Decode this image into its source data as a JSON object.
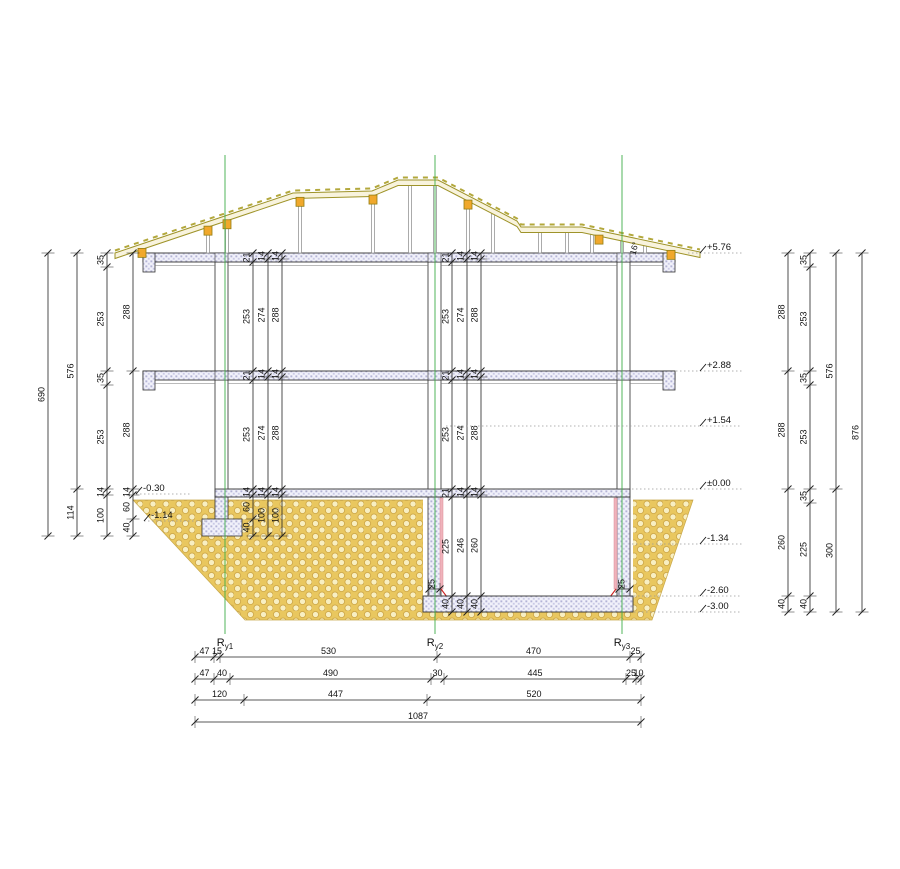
{
  "drawing": {
    "angle_label": "16°",
    "axes": [
      {
        "base": "R",
        "sub": "y1"
      },
      {
        "base": "R",
        "sub": "y2"
      },
      {
        "base": "R",
        "sub": "y3"
      }
    ],
    "elevations_right": [
      "+5.76",
      "+2.88",
      "+1.54",
      "±0.00",
      "-1.34",
      "-2.60",
      "-3.00"
    ],
    "elevations_left": [
      "-0.30",
      "-1.14"
    ],
    "dims": {
      "left_total": [
        "690"
      ],
      "left_sub": [
        "576",
        "114"
      ],
      "left_storey": [
        "35",
        "253",
        "35",
        "253",
        "14",
        "100"
      ],
      "left_inner": [
        "288",
        "288",
        "14",
        "60",
        "40"
      ],
      "int_l1": [
        "21",
        "253",
        "21",
        "253",
        "14",
        "60",
        "40"
      ],
      "int_l2": [
        "14",
        "274",
        "14",
        "274",
        "14",
        "100"
      ],
      "int_l3": [
        "14",
        "288",
        "14",
        "288",
        "14",
        "100"
      ],
      "int_m1": [
        "21",
        "253",
        "21",
        "253",
        "21",
        "225",
        "40"
      ],
      "int_m2": [
        "14",
        "274",
        "14",
        "274",
        "14",
        "246",
        "40"
      ],
      "int_m3": [
        "14",
        "288",
        "14",
        "288",
        "14",
        "260",
        "40"
      ],
      "right_inner": [
        "288",
        "288",
        "260",
        "40"
      ],
      "right_storey": [
        "35",
        "253",
        "35",
        "253",
        "35",
        "225",
        "40"
      ],
      "right_sub": [
        "576",
        "300"
      ],
      "right_total": [
        "876"
      ],
      "bottom_r1": [
        "47",
        "15",
        "530",
        "470",
        "25"
      ],
      "bottom_r2": [
        "47",
        "40",
        "490",
        "30",
        "445",
        "25",
        "10"
      ],
      "bottom_r3": [
        "120",
        "447",
        "520"
      ],
      "bottom_r4": [
        "1087"
      ],
      "bw_left": [
        "25"
      ],
      "bw_right": [
        "25"
      ]
    },
    "colors": {
      "axis_green": "#3fae49",
      "roof_olive": "#9e9329",
      "purlin_orange": "#f0a82c",
      "soil_tan": "#e9c75f",
      "hatch_lavender": "#b4b4d6",
      "waterproof_pink": "#efb3bb",
      "accent_red": "#cc2222"
    }
  }
}
